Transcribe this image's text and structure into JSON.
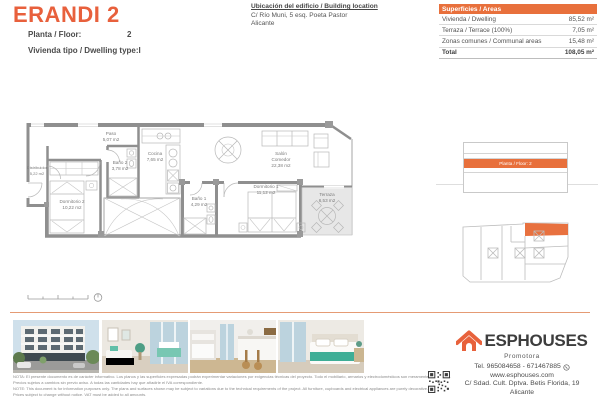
{
  "header": {
    "title": "ERANDI 2",
    "floor_label": "Planta / Floor:",
    "floor_value": "2",
    "dwelling_label": "Vivienda tipo / Dwelling type:",
    "dwelling_value": "I",
    "location_heading": "Ubicación del edificio / Building location",
    "location_line1": "C/ Río Muni, 5 esq. Poeta Pastor",
    "location_line2": "Alicante"
  },
  "areas_table": {
    "header": "Superficies / Areas",
    "rows": [
      {
        "label": "Vivienda / Dwelling",
        "value": "85,52 m²"
      },
      {
        "label": "Terraza / Terrace (100%)",
        "value": "7,05 m²"
      },
      {
        "label": "Zonas comunes / Communal areas",
        "value": "15,48 m²"
      }
    ],
    "total_label": "Total",
    "total_value": "108,05 m²"
  },
  "floorplan": {
    "rooms": {
      "distribuidor": {
        "name": "Distribuidor",
        "area": "5,22 m2"
      },
      "paso": {
        "name": "Paso",
        "area": "5,07 m2"
      },
      "bano2": {
        "name": "Baño 2",
        "area": "3,78 m2"
      },
      "cocina": {
        "name": "Cocina",
        "area": "7,65 m2"
      },
      "dormitorio2": {
        "name": "Dormitorio 2",
        "area": "10,22 m2"
      },
      "salon": {
        "name": "Salón",
        "name2": "Comedor",
        "area": "22,38 m2"
      },
      "bano1": {
        "name": "Baño 1",
        "area": "4,29 m2"
      },
      "dormitorio1": {
        "name": "Dormitorio 1",
        "area": "11,12 m2"
      },
      "terraza": {
        "name": "Terraza",
        "area": "6,53 m2"
      }
    }
  },
  "elevation": {
    "highlight_label": "Planta / Floor: 2"
  },
  "photos": [
    "building-exterior",
    "living-room",
    "kitchen-dining",
    "bedroom"
  ],
  "footer": {
    "note_es_1": "NOTA: El presente documento es de carácter informativo. Los planos y las superficies expresadas podrán experimentar variaciones por exigencias técnicas del proyecto. Todo el mobiliario, armarios y electrodomésticos son meramente decorativos.",
    "note_es_2": "Precios sujetos a cambios sin previo aviso. A todas las cantidades hay que añadirle el IVA correspondiente.",
    "note_en_1": "NOTE: This document is for information purposes only. The plans and surfaces shown may be subject to variations due to the technical requirements of the project. All furniture, cupboards and electrical appliances are purely decorative.",
    "note_en_2": "Prices subject to change without notice. VAT must be added to all amounts.",
    "brand": "ESPHOUSES",
    "brand_sub": "Promotora",
    "contact_tel": "Tel. 965084658 - 671467885",
    "contact_web": "www.esphouses.com",
    "contact_address": "C/ Sdad. Cult. Dptva. Betis Florida, 19",
    "contact_city": "Alicante"
  },
  "colors": {
    "accent": "#E8663D",
    "table_header": "#E8703C",
    "divider": "#E59B74",
    "text_dark": "#4B4B4B"
  }
}
